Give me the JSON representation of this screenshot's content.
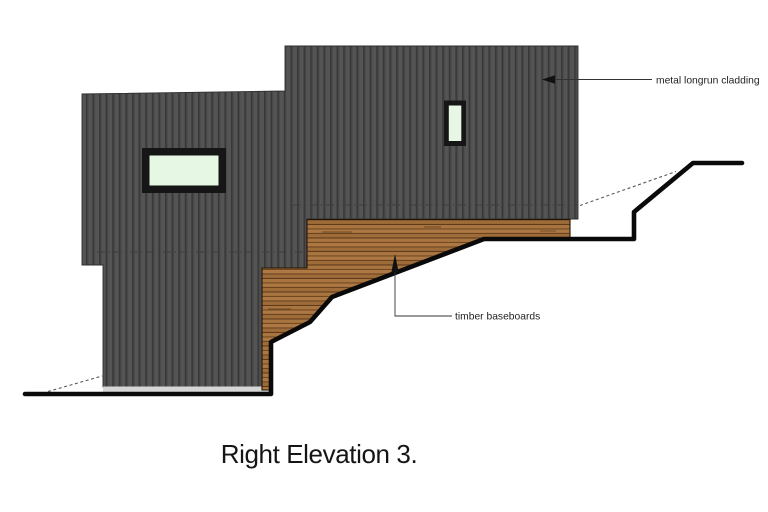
{
  "drawing": {
    "title": "Right Elevation 3.",
    "annotations": {
      "cladding_label": "metal longrun cladding",
      "baseboards_label": "timber baseboards"
    },
    "windows": {
      "count": 2,
      "left_window": "horizontal fixed window",
      "right_window": "vertical fixed window"
    },
    "colors": {
      "background": "#ffffff",
      "cladding_base": "#545454",
      "cladding_stripe": "#383838",
      "timber_base": "#a8723e",
      "timber_line": "#6b441f",
      "window_glass": "#e6f7e3",
      "window_frame": "#161616",
      "ground_line": "#0a0a0a",
      "plinth_strip": "#d6d6d6",
      "text": "#1f1f1f"
    }
  }
}
